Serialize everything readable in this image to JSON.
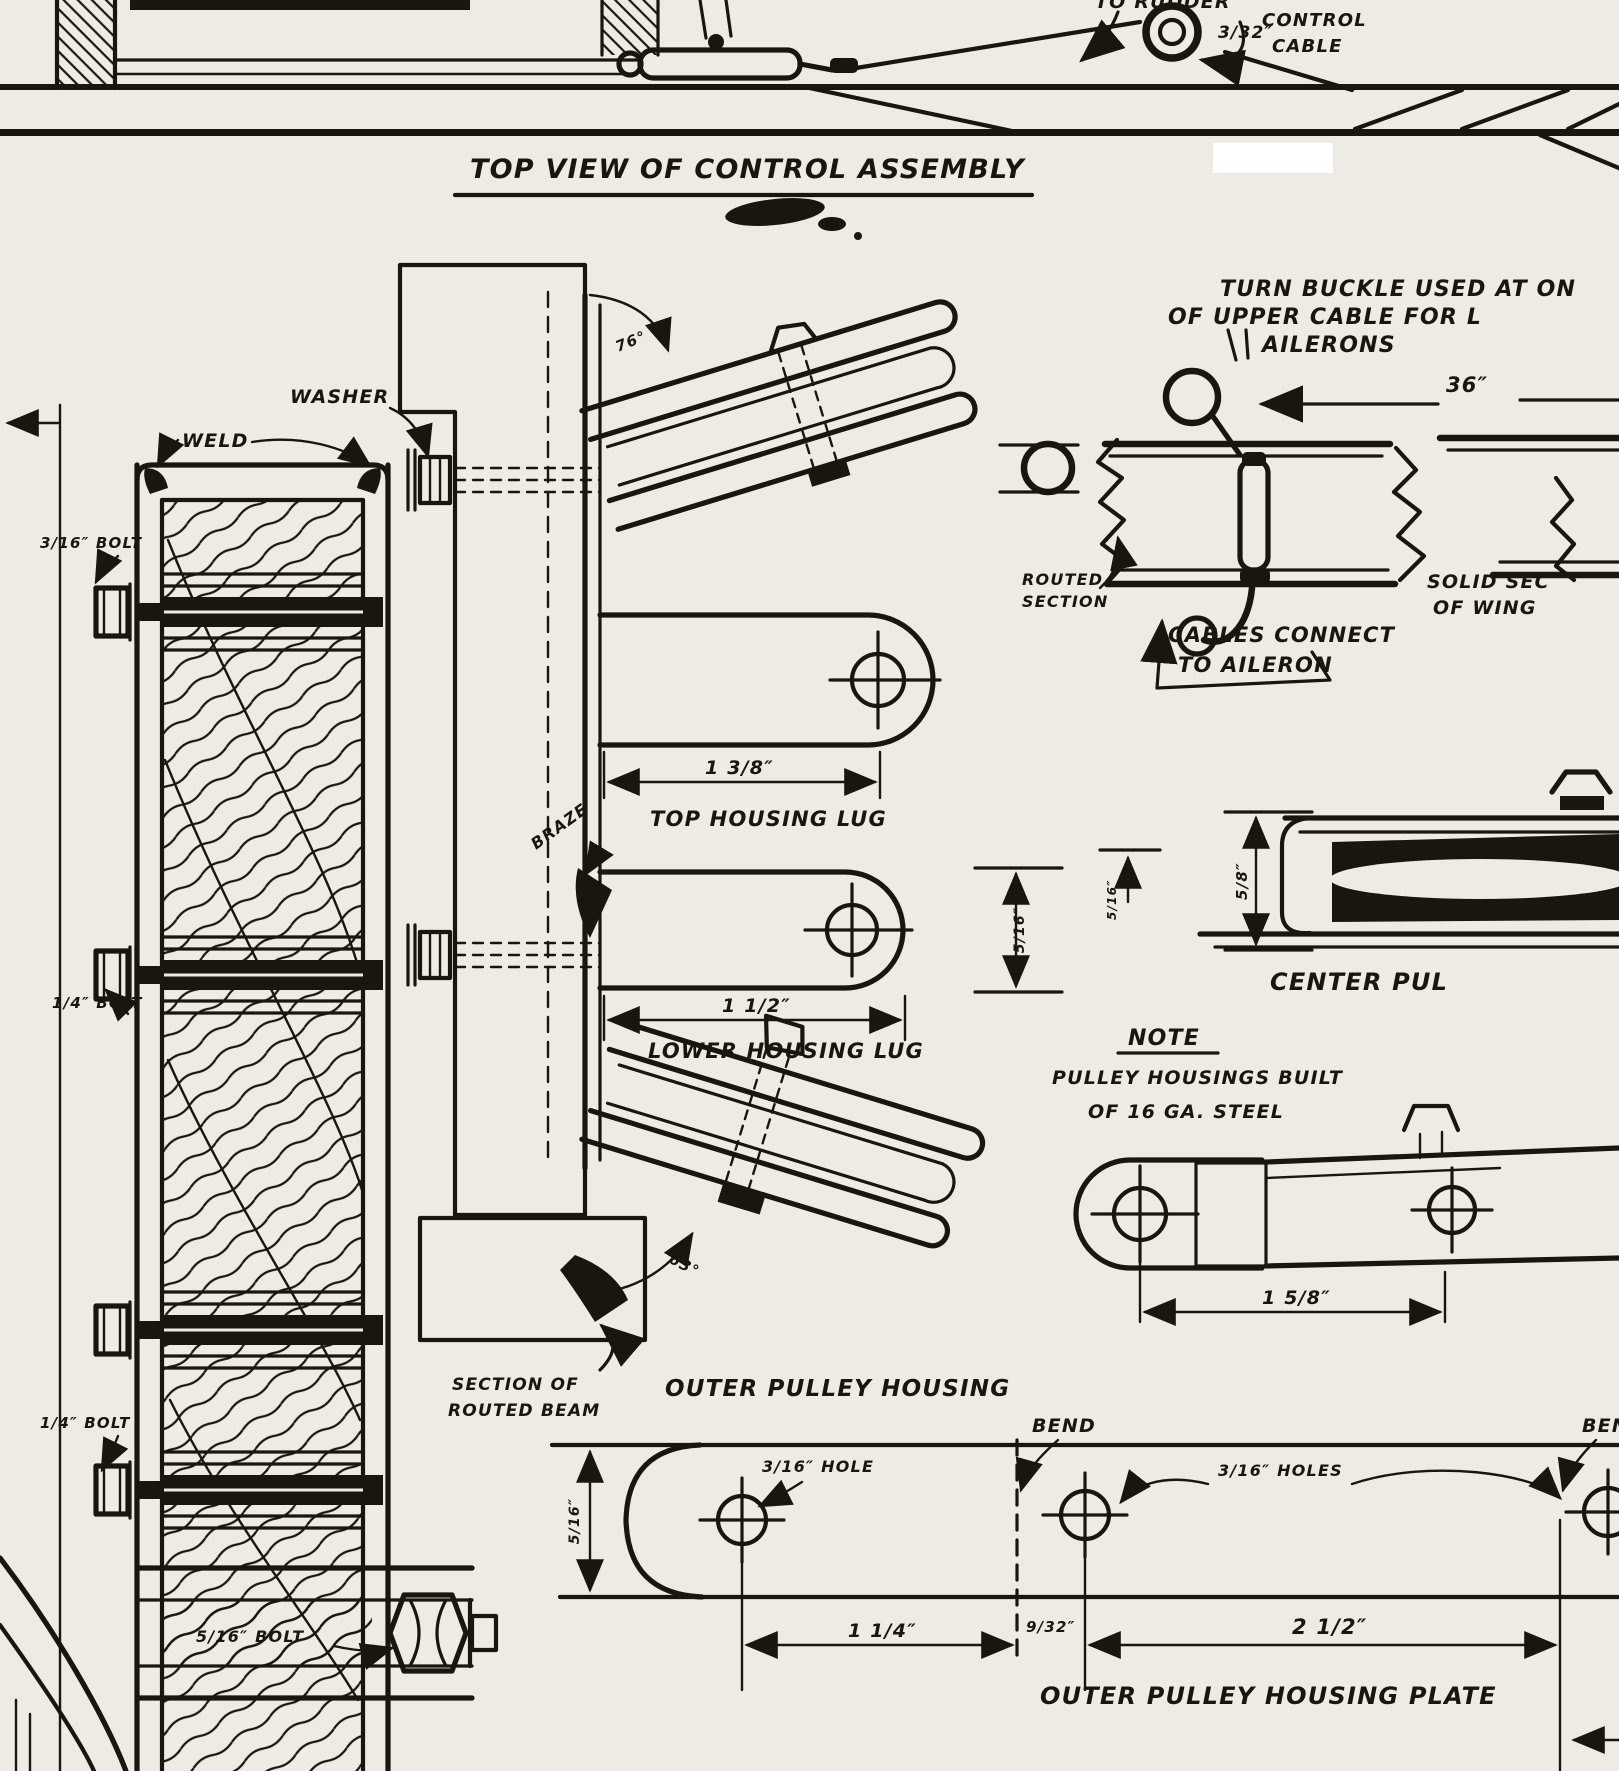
{
  "colors": {
    "ink": "#1b1510",
    "paper": "#edebe3"
  },
  "header": {
    "to_rudder": "TO RUDDER",
    "cable_size": "3/32″",
    "cable_word1": "CONTROL",
    "cable_word2": "CABLE",
    "title": "TOP VIEW OF CONTROL ASSEMBLY"
  },
  "rigging": {
    "turnbuckle_note1": "TURN BUCKLE USED AT ON",
    "turnbuckle_note2": "OF UPPER CABLE FOR L",
    "turnbuckle_note3": "AILERONS",
    "dim_36": "36″",
    "routed1": "ROUTED",
    "routed2": "SECTION",
    "solid1": "SOLID SEC",
    "solid2": "OF WING",
    "cables1": "CABLES CONNECT",
    "cables2": "TO AILERON"
  },
  "assembly": {
    "washer": "WASHER",
    "weld": "WELD",
    "bolt_top": "3/16″ BOLT",
    "bolt_mid": "1/4″ BOLT",
    "bolt_lower": "1/4″ BOLT",
    "bolt_bottom": "5/16″ BOLT",
    "angle_top": "76°",
    "angle_bottom": "63°",
    "braze": "BRAZE",
    "section1": "SECTION OF",
    "section2": "ROUTED BEAM",
    "outer_housing": "OUTER PULLEY HOUSING"
  },
  "lugs": {
    "top_dim": "1 3/8″",
    "top_label": "TOP HOUSING LUG",
    "lower_dim": "1 1/2″",
    "lower_label": "LOWER HOUSING LUG",
    "height_dim": "5/16″"
  },
  "note": {
    "head": "NOTE",
    "line1": "PULLEY HOUSINGS BUILT",
    "line2": "OF 16 GA. STEEL"
  },
  "center_pulley": {
    "label": "CENTER PUL",
    "dim_side": "5/8″",
    "dim_left": "5/16″"
  },
  "housing_piece": {
    "dim": "1 5/8″"
  },
  "plate": {
    "bend": "BEND",
    "bend_right": "BEN",
    "hole": "3/16″ HOLE",
    "holes": "3/16″ HOLES",
    "height_dim": "5/16″",
    "dim1": "1 1/4″",
    "dim2": "9/32″",
    "dim3": "2 1/2″",
    "title": "OUTER PULLEY HOUSING PLATE"
  }
}
